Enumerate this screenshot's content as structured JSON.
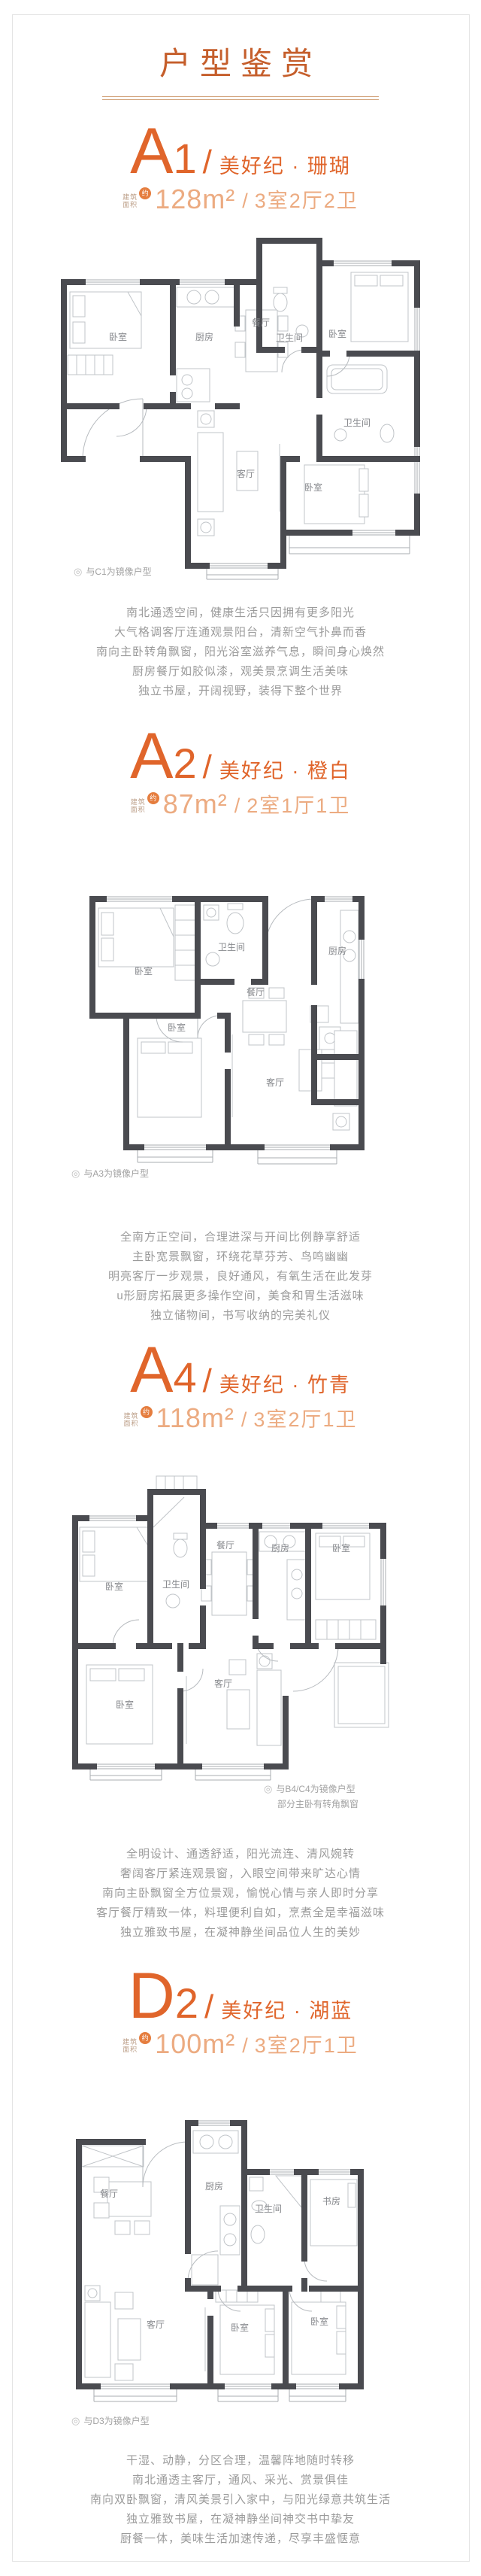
{
  "page": {
    "title": "户型鉴赏"
  },
  "icons": {
    "mirror": "◎"
  },
  "colors": {
    "accent": "#e0652b",
    "accent_title": "#c55e2b",
    "accent_light": "#ecab81",
    "badge": "#e57d3e",
    "rule": "#cf9d72",
    "wall": "#4a4b50",
    "furniture": "#c0c4c8",
    "room_label": "#87898d",
    "body_text": "#9b9b9b"
  },
  "area_prefix": {
    "line1": "建筑",
    "line2": "面积",
    "badge": "约"
  },
  "units": [
    {
      "letter": "A",
      "digit": "1",
      "slash": "/",
      "name": "美好纪 · 珊瑚",
      "area": "128m²",
      "sep": "/",
      "layout": "3室2厅2卫",
      "notes": [
        "与C1为镜像户型"
      ],
      "rooms": [
        "卧室",
        "厨房",
        "餐厅",
        "卫生间",
        "卧室",
        "卫生间",
        "客厅",
        "卧室"
      ],
      "desc": [
        "南北通透空间，健康生活只因拥有更多阳光",
        "大气格调客厅连通观景阳台，清新空气扑鼻而香",
        "南向主卧转角飘窗，阳光浴室滋养气息，瞬间身心焕然",
        "厨房餐厅如胶似漆，观美景烹调生活美味",
        "独立书屋，开阔视野，装得下整个世界"
      ]
    },
    {
      "letter": "A",
      "digit": "2",
      "slash": "/",
      "name": "美好纪 · 橙白",
      "area": "87m²",
      "sep": "/",
      "layout": "2室1厅1卫",
      "notes": [
        "与A3为镜像户型"
      ],
      "rooms": [
        "卧室",
        "卫生间",
        "厨房",
        "卧室",
        "餐厅",
        "客厅"
      ],
      "desc": [
        "全南方正空间，合理进深与开间比例静享舒适",
        "主卧宽景飘窗，环绕花草芬芳、鸟鸣幽幽",
        "明亮客厅一步观景，良好通风，有氧生活在此发芽",
        "u形厨房拓展更多操作空间，美食和胃生活滋味",
        "独立储物间，书写收纳的完美礼仪"
      ]
    },
    {
      "letter": "A",
      "digit": "4",
      "slash": "/",
      "name": "美好纪 · 竹青",
      "area": "118m²",
      "sep": "/",
      "layout": "3室2厅1卫",
      "notes": [
        "与B4/C4为镜像户型",
        "部分主卧有转角飘窗"
      ],
      "rooms": [
        "卧室",
        "卫生间",
        "餐厅",
        "厨房",
        "卧室",
        "卧室",
        "客厅"
      ],
      "desc": [
        "全明设计、通透舒适，阳光流连、清风婉转",
        "奢阔客厅紧连观景窗，入眼空间带来旷达心情",
        "南向主卧飘窗全方位景观，愉悦心情与亲人即时分享",
        "客厅餐厅精致一体，料理便利自如，烹煮全是幸福滋味",
        "独立雅致书屋，在凝神静坐间品位人生的美妙"
      ]
    },
    {
      "letter": "D",
      "digit": "2",
      "slash": "/",
      "name": "美好纪 · 湖蓝",
      "area": "100m²",
      "sep": "/",
      "layout": "3室2厅1卫",
      "notes": [
        "与D3为镜像户型"
      ],
      "rooms": [
        "餐厅",
        "厨房",
        "卫生间",
        "书房",
        "客厅",
        "卧室",
        "卧室"
      ],
      "desc": [
        "干湿、动静，分区合理，温馨阵地随时转移",
        "南北通透主客厅，通风、采光、赏景俱佳",
        "南向双卧飘窗，清风美景引入家中，与阳光绿意共筑生活",
        "独立雅致书屋，在凝神静坐间神交书中挚友",
        "厨餐一体，美味生活加速传递，尽享丰盛惬意"
      ]
    }
  ]
}
